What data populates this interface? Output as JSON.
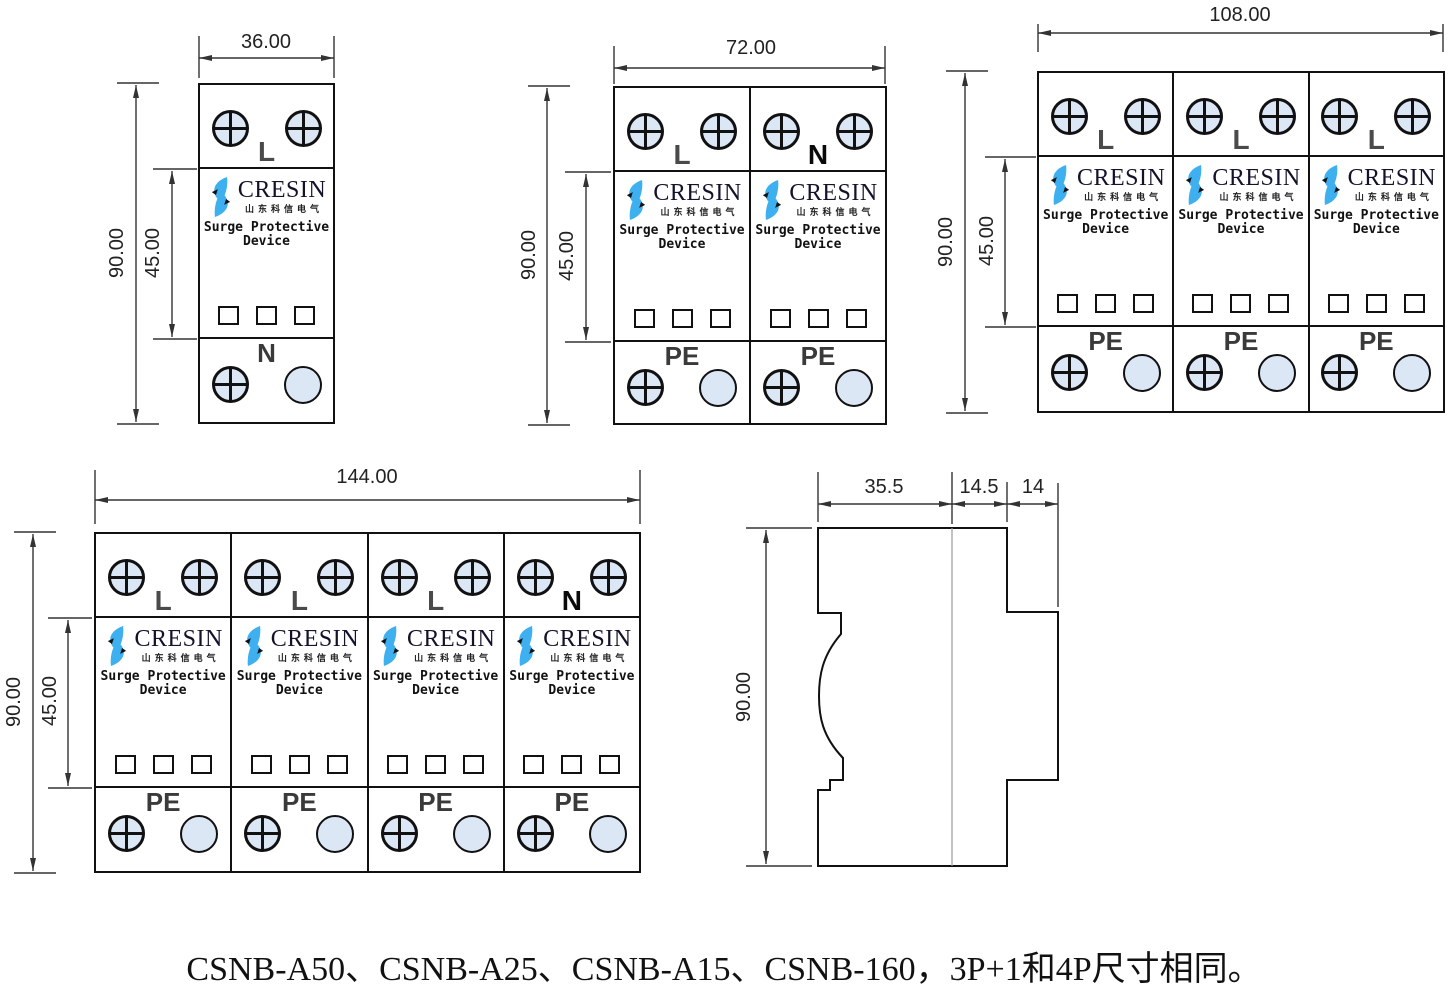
{
  "caption": "CSNB-A50、CSNB-A25、CSNB-A15、CSNB-160，3P+1和4P尺寸相同。",
  "brand": {
    "name": "CRESIN",
    "subtitle": "山东科信电气",
    "product_line1": "Surge Protective",
    "product_line2": "Device"
  },
  "colors": {
    "logo_blue": "#3EB0F0",
    "screw_fill": "#DCE7F6",
    "object_line": "#111111",
    "dimension_line": "#333333"
  },
  "units": [
    {
      "poles": "1P",
      "dim_width": "36.00",
      "dim_height": "90.00",
      "dim_inner": "45.00",
      "modules": [
        {
          "top_label": "L",
          "bottom_label": "N"
        }
      ]
    },
    {
      "poles": "2P",
      "dim_width": "72.00",
      "dim_height": "90.00",
      "dim_inner": "45.00",
      "modules": [
        {
          "top_label": "L",
          "bottom_label": "PE"
        },
        {
          "top_label": "N",
          "bottom_label": "PE"
        }
      ]
    },
    {
      "poles": "3P",
      "dim_width": "108.00",
      "dim_height": "90.00",
      "dim_inner": "45.00",
      "modules": [
        {
          "top_label": "L",
          "bottom_label": "PE"
        },
        {
          "top_label": "L",
          "bottom_label": "PE"
        },
        {
          "top_label": "L",
          "bottom_label": "PE"
        }
      ]
    },
    {
      "poles": "4P",
      "dim_width": "144.00",
      "dim_height": "90.00",
      "dim_inner": "45.00",
      "modules": [
        {
          "top_label": "L",
          "bottom_label": "PE"
        },
        {
          "top_label": "L",
          "bottom_label": "PE"
        },
        {
          "top_label": "L",
          "bottom_label": "PE"
        },
        {
          "top_label": "N",
          "bottom_label": "PE"
        }
      ]
    }
  ],
  "side_view": {
    "dim_body_depth": "35.5",
    "dim_mid_depth": "14.5",
    "dim_clip_depth": "14",
    "dim_height": "90.00"
  }
}
